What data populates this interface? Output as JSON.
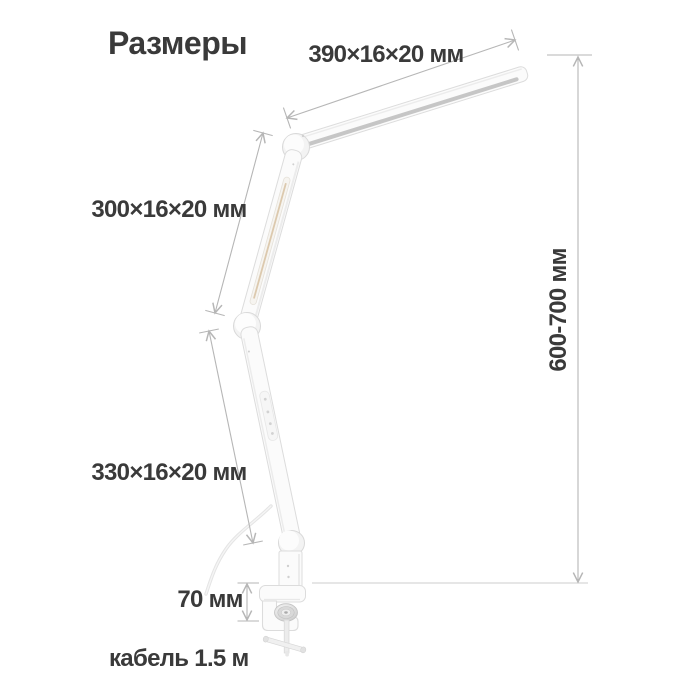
{
  "diagram": {
    "title": "Размеры",
    "dimensions": {
      "head": "390×16×20 мм",
      "upper_arm": "300×16×20 мм",
      "lower_arm": "330×16×20 мм",
      "height_range": "600-700 мм",
      "clamp_height": "70 мм",
      "cable_length": "кабель 1.5 м"
    },
    "colors": {
      "background": "#ffffff",
      "text": "#3a3a3a",
      "dimension_line": "#b6b6b6",
      "lamp_outline": "#dcdcdc",
      "diffuser_strip": "#c6c6c6",
      "led_channel": "#dcc9ae",
      "table_line": "#cdcdcd"
    }
  }
}
